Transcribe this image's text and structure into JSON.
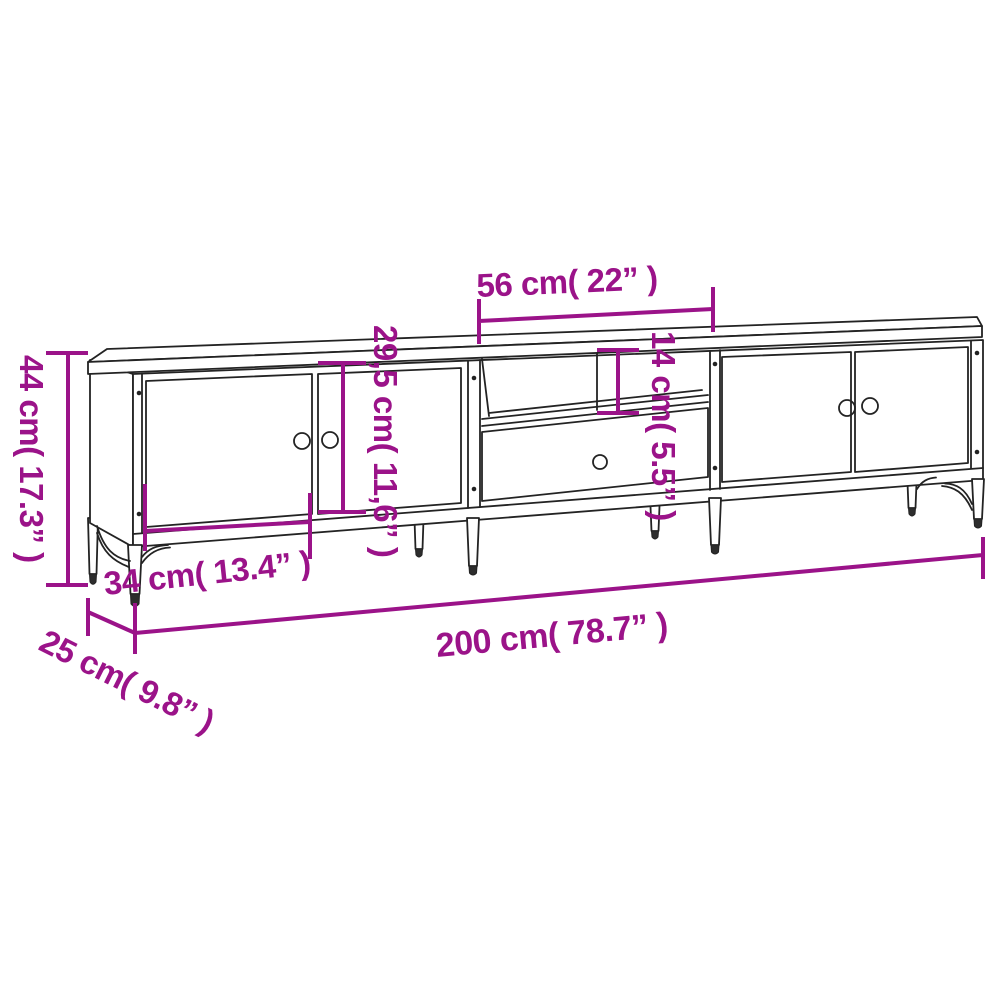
{
  "title": "TV cabinet dimension diagram",
  "colors": {
    "dimension_magenta": "#9B1389",
    "drawing_line": "#232323",
    "background": "#FFFFFF"
  },
  "dimensions": {
    "overall_height": "44 cm( 17.3” )",
    "middle_compartment_width": "56 cm( 22” )",
    "door_height": "29,5 cm( 11,6” )",
    "open_shelf_height": "14 cm( 5.5” )",
    "door_width": "34 cm( 13.4” )",
    "overall_width": "200 cm( 78.7” )",
    "overall_depth": "25 cm( 9.8” )"
  }
}
